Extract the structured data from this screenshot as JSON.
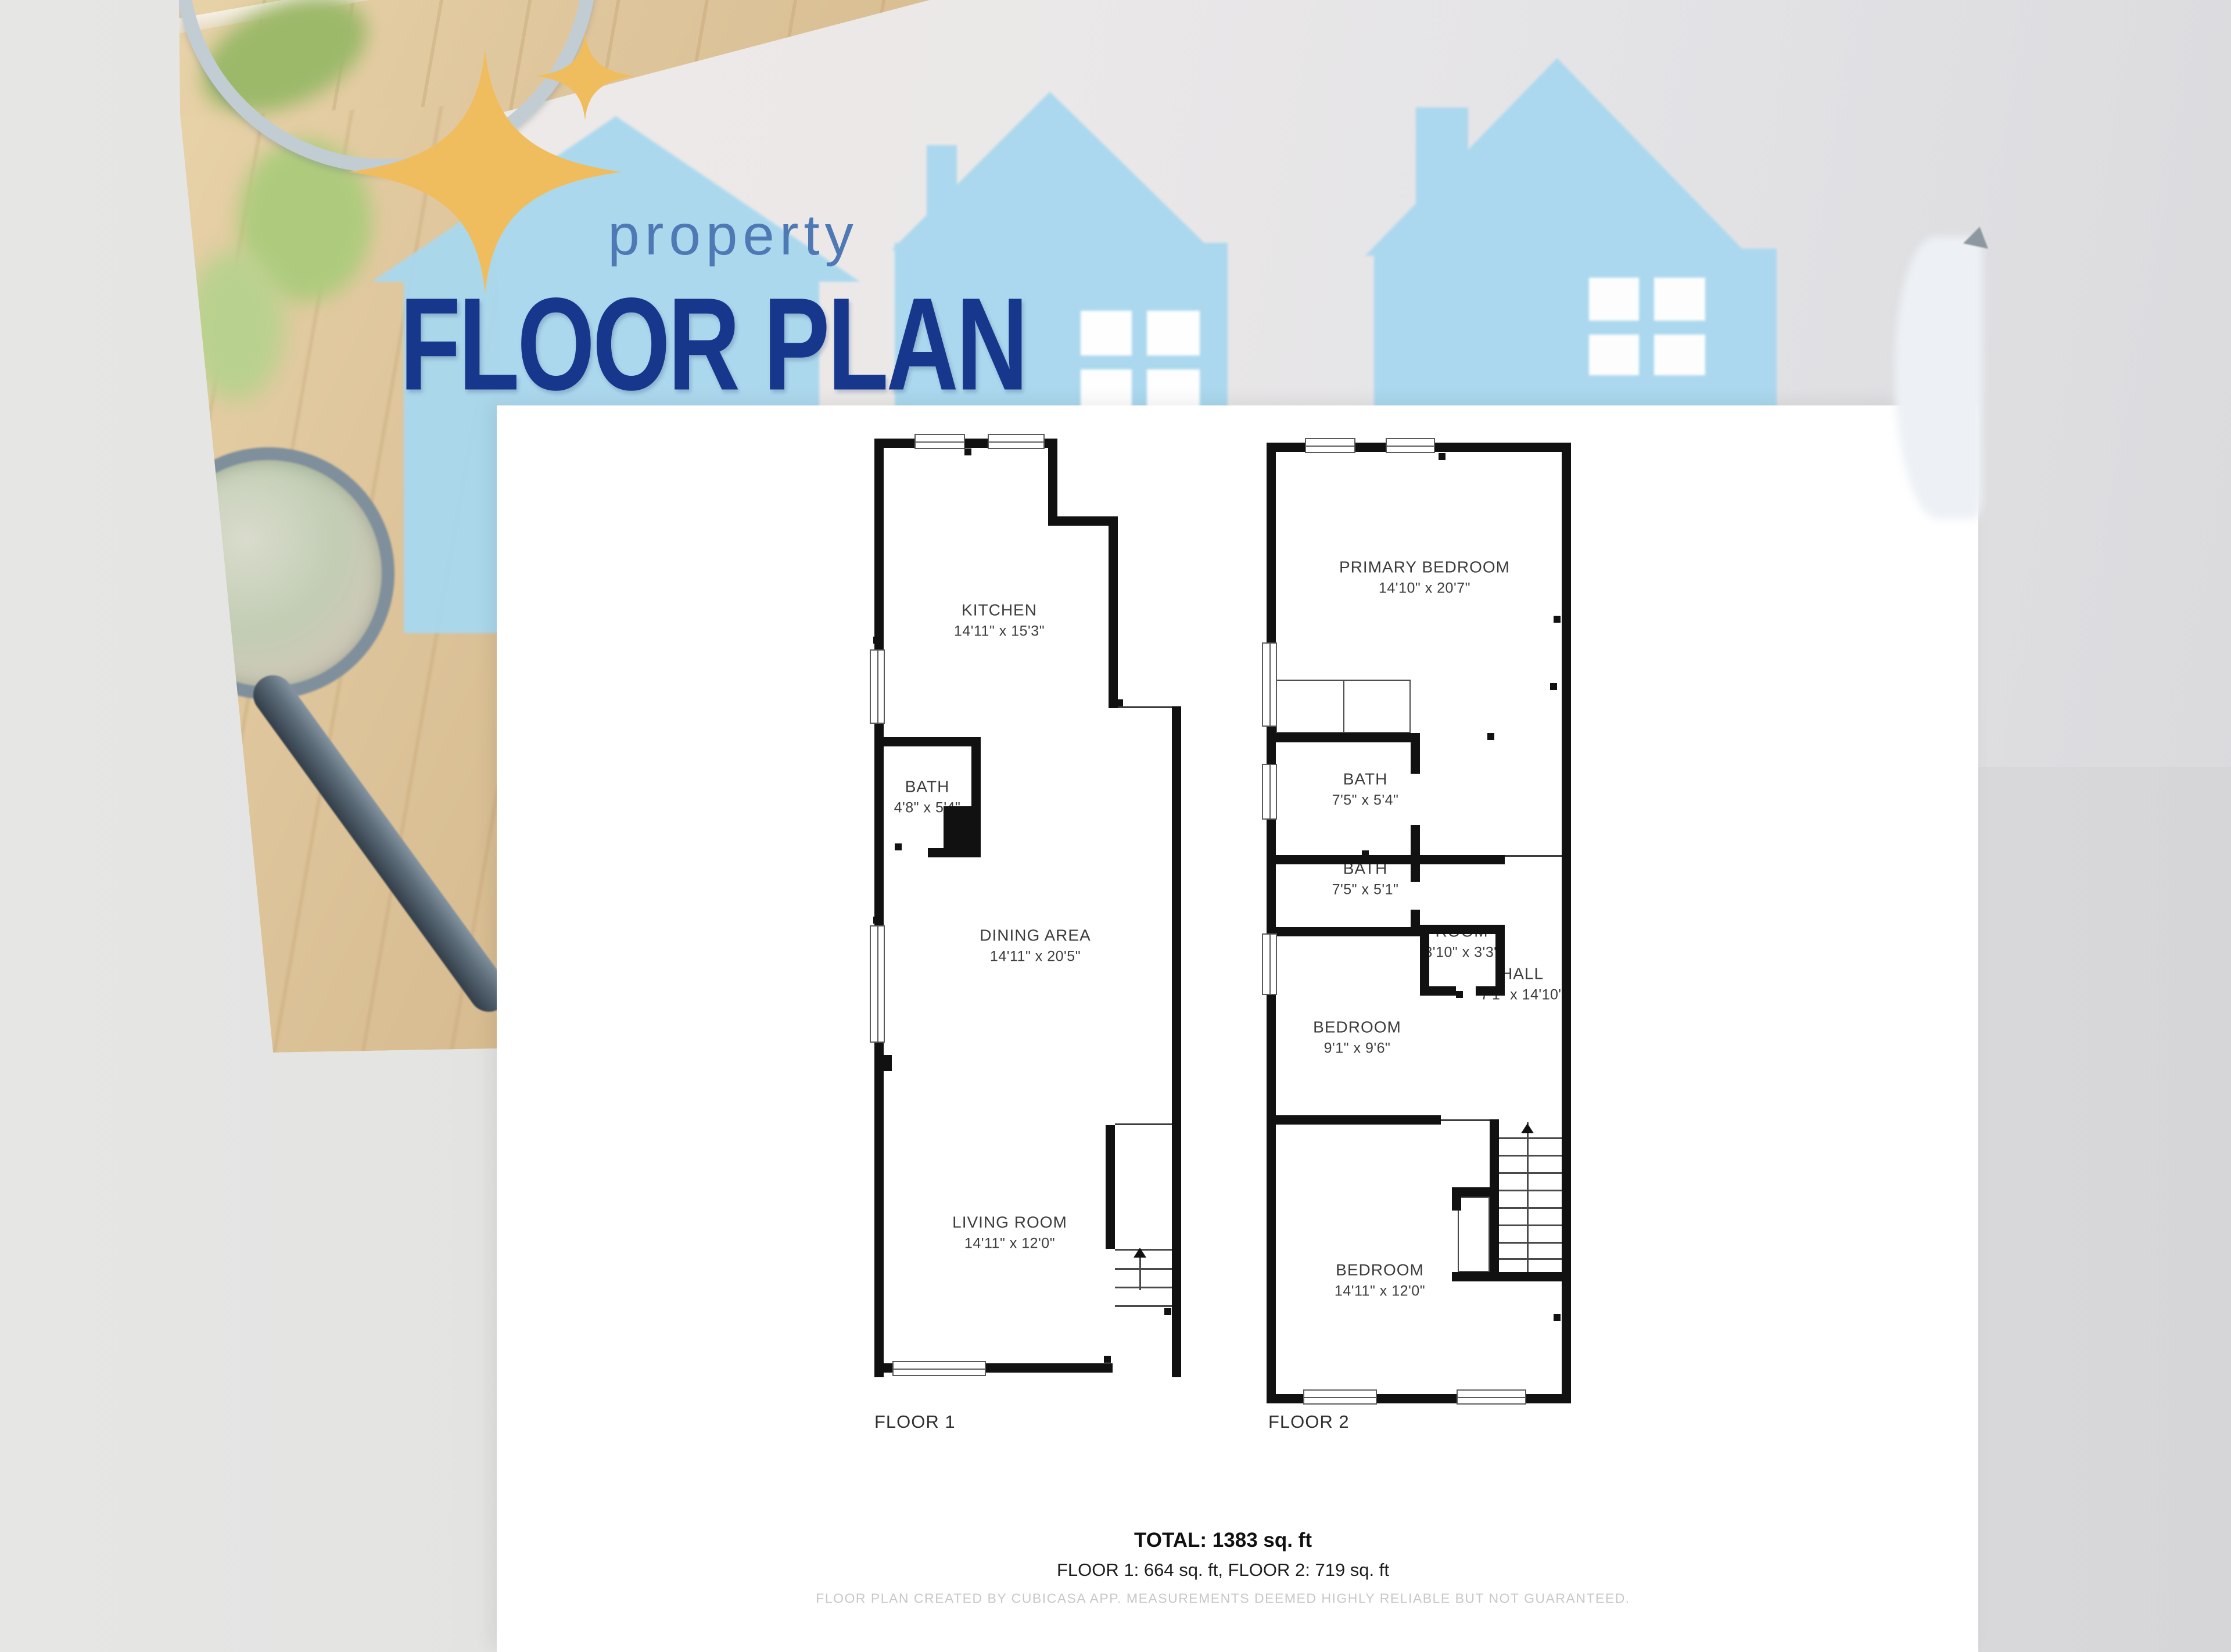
{
  "title": {
    "small": "property",
    "big": "FLOOR PLAN"
  },
  "sheet": {
    "floor1": {
      "label": "FLOOR 1",
      "rooms": [
        {
          "name": "KITCHEN",
          "dims": "14'11\" x 15'3\""
        },
        {
          "name": "BATH",
          "dims": "4'8\" x 5'4\""
        },
        {
          "name": "DINING AREA",
          "dims": "14'11\" x 20'5\""
        },
        {
          "name": "LIVING ROOM",
          "dims": "14'11\" x 12'0\""
        }
      ]
    },
    "floor2": {
      "label": "FLOOR 2",
      "rooms": [
        {
          "name": "PRIMARY BEDROOM",
          "dims": "14'10\" x 20'7\""
        },
        {
          "name": "BATH",
          "dims": "7'5\" x 5'4\""
        },
        {
          "name": "BATH",
          "dims": "7'5\" x 5'1\""
        },
        {
          "name": "ROOM",
          "dims": "3'10\" x 3'3\""
        },
        {
          "name": "HALL",
          "dims": "7'1\" x 14'10\""
        },
        {
          "name": "BEDROOM",
          "dims": "9'1\" x 9'6\""
        },
        {
          "name": "BEDROOM",
          "dims": "14'11\" x 12'0\""
        }
      ]
    },
    "summary": {
      "total": "TOTAL: 1383 sq. ft",
      "breakdown": "FLOOR 1: 664 sq. ft, FLOOR 2: 719 sq. ft",
      "disclaimer": "FLOOR PLAN CREATED BY CUBICASA APP. MEASUREMENTS DEEMED HIGHLY RELIABLE BUT NOT GUARANTEED."
    }
  },
  "colors": {
    "title_navy": "#16378c",
    "title_blue": "#4e79b4",
    "sparkle_gold": "#f0bd5e",
    "house_blue": "#a9d8ef",
    "wall_black": "#111111",
    "sheet_white": "#ffffff"
  }
}
